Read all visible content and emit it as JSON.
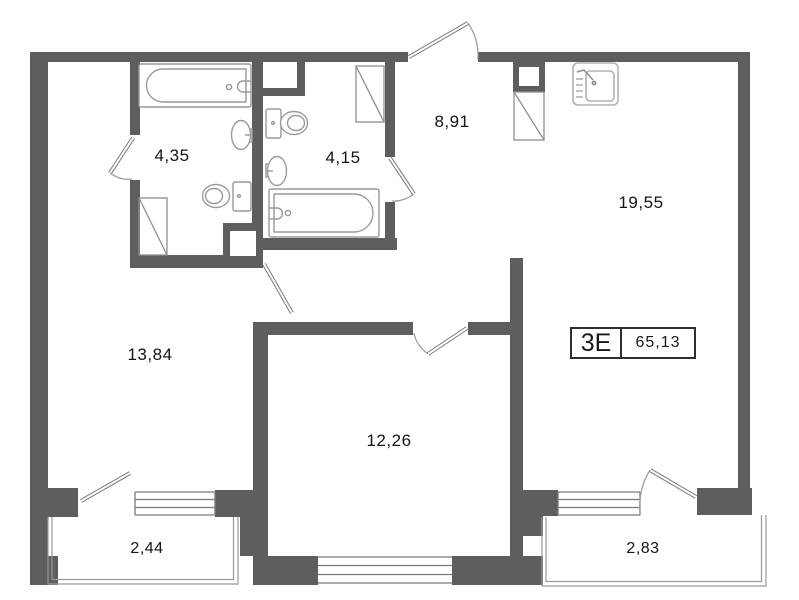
{
  "plan": {
    "unit": {
      "label": "3Е",
      "total_area": "65,13"
    },
    "rooms": [
      {
        "name": "bathroom-1",
        "area": "4,35"
      },
      {
        "name": "bathroom-2",
        "area": "4,15"
      },
      {
        "name": "hallway",
        "area": "8,91"
      },
      {
        "name": "kitchen-living-room",
        "area": "19,55"
      },
      {
        "name": "bedroom",
        "area": "13,84"
      },
      {
        "name": "room-2",
        "area": "12,26"
      },
      {
        "name": "balcony-left",
        "area": "2,44"
      },
      {
        "name": "balcony-right",
        "area": "2,83"
      }
    ],
    "fixtures": [
      "bathtub-icon",
      "toilet-icon",
      "sink-icon",
      "corner-shower-icon",
      "washing-machine-icon",
      "kitchen-sink-icon",
      "duct-shaft-icon",
      "door-swing-icon",
      "window-icon",
      "balcony-rail-icon"
    ],
    "colors": {
      "wall": "#5d5e60",
      "fixture_line": "#9a9a9a",
      "door_line": "#7a7a7a",
      "text": "#141414",
      "background": "#ffffff"
    }
  }
}
